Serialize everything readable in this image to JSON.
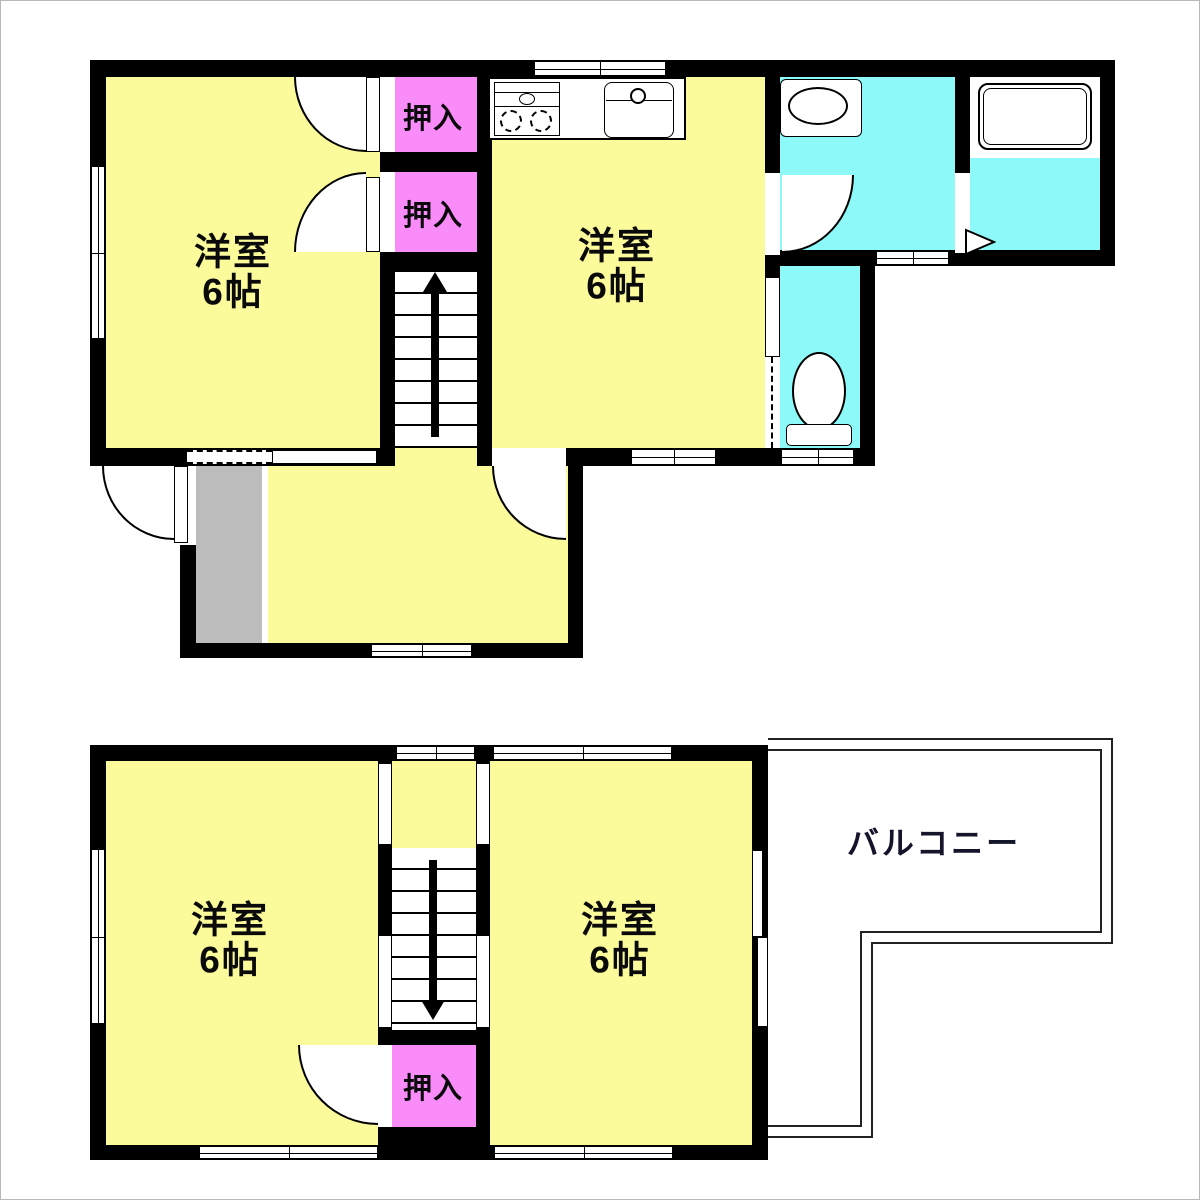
{
  "floor1": {
    "room_left": {
      "name": "洋室",
      "size": "6帖"
    },
    "room_right": {
      "name": "洋室",
      "size": "6帖"
    },
    "closet_upper": "押入",
    "closet_lower": "押入"
  },
  "floor2": {
    "room_left": {
      "name": "洋室",
      "size": "6帖"
    },
    "room_right": {
      "name": "洋室",
      "size": "6帖"
    },
    "closet": "押入",
    "balcony": "バルコニー"
  },
  "colors": {
    "room_yellow": "#fbfb9b",
    "closet_pink": "#f98cf9",
    "water_cyan": "#8ef9f9",
    "entrance_gray": "#bcbcbc",
    "wall_black": "#000000",
    "balcony_line": "#222222"
  }
}
